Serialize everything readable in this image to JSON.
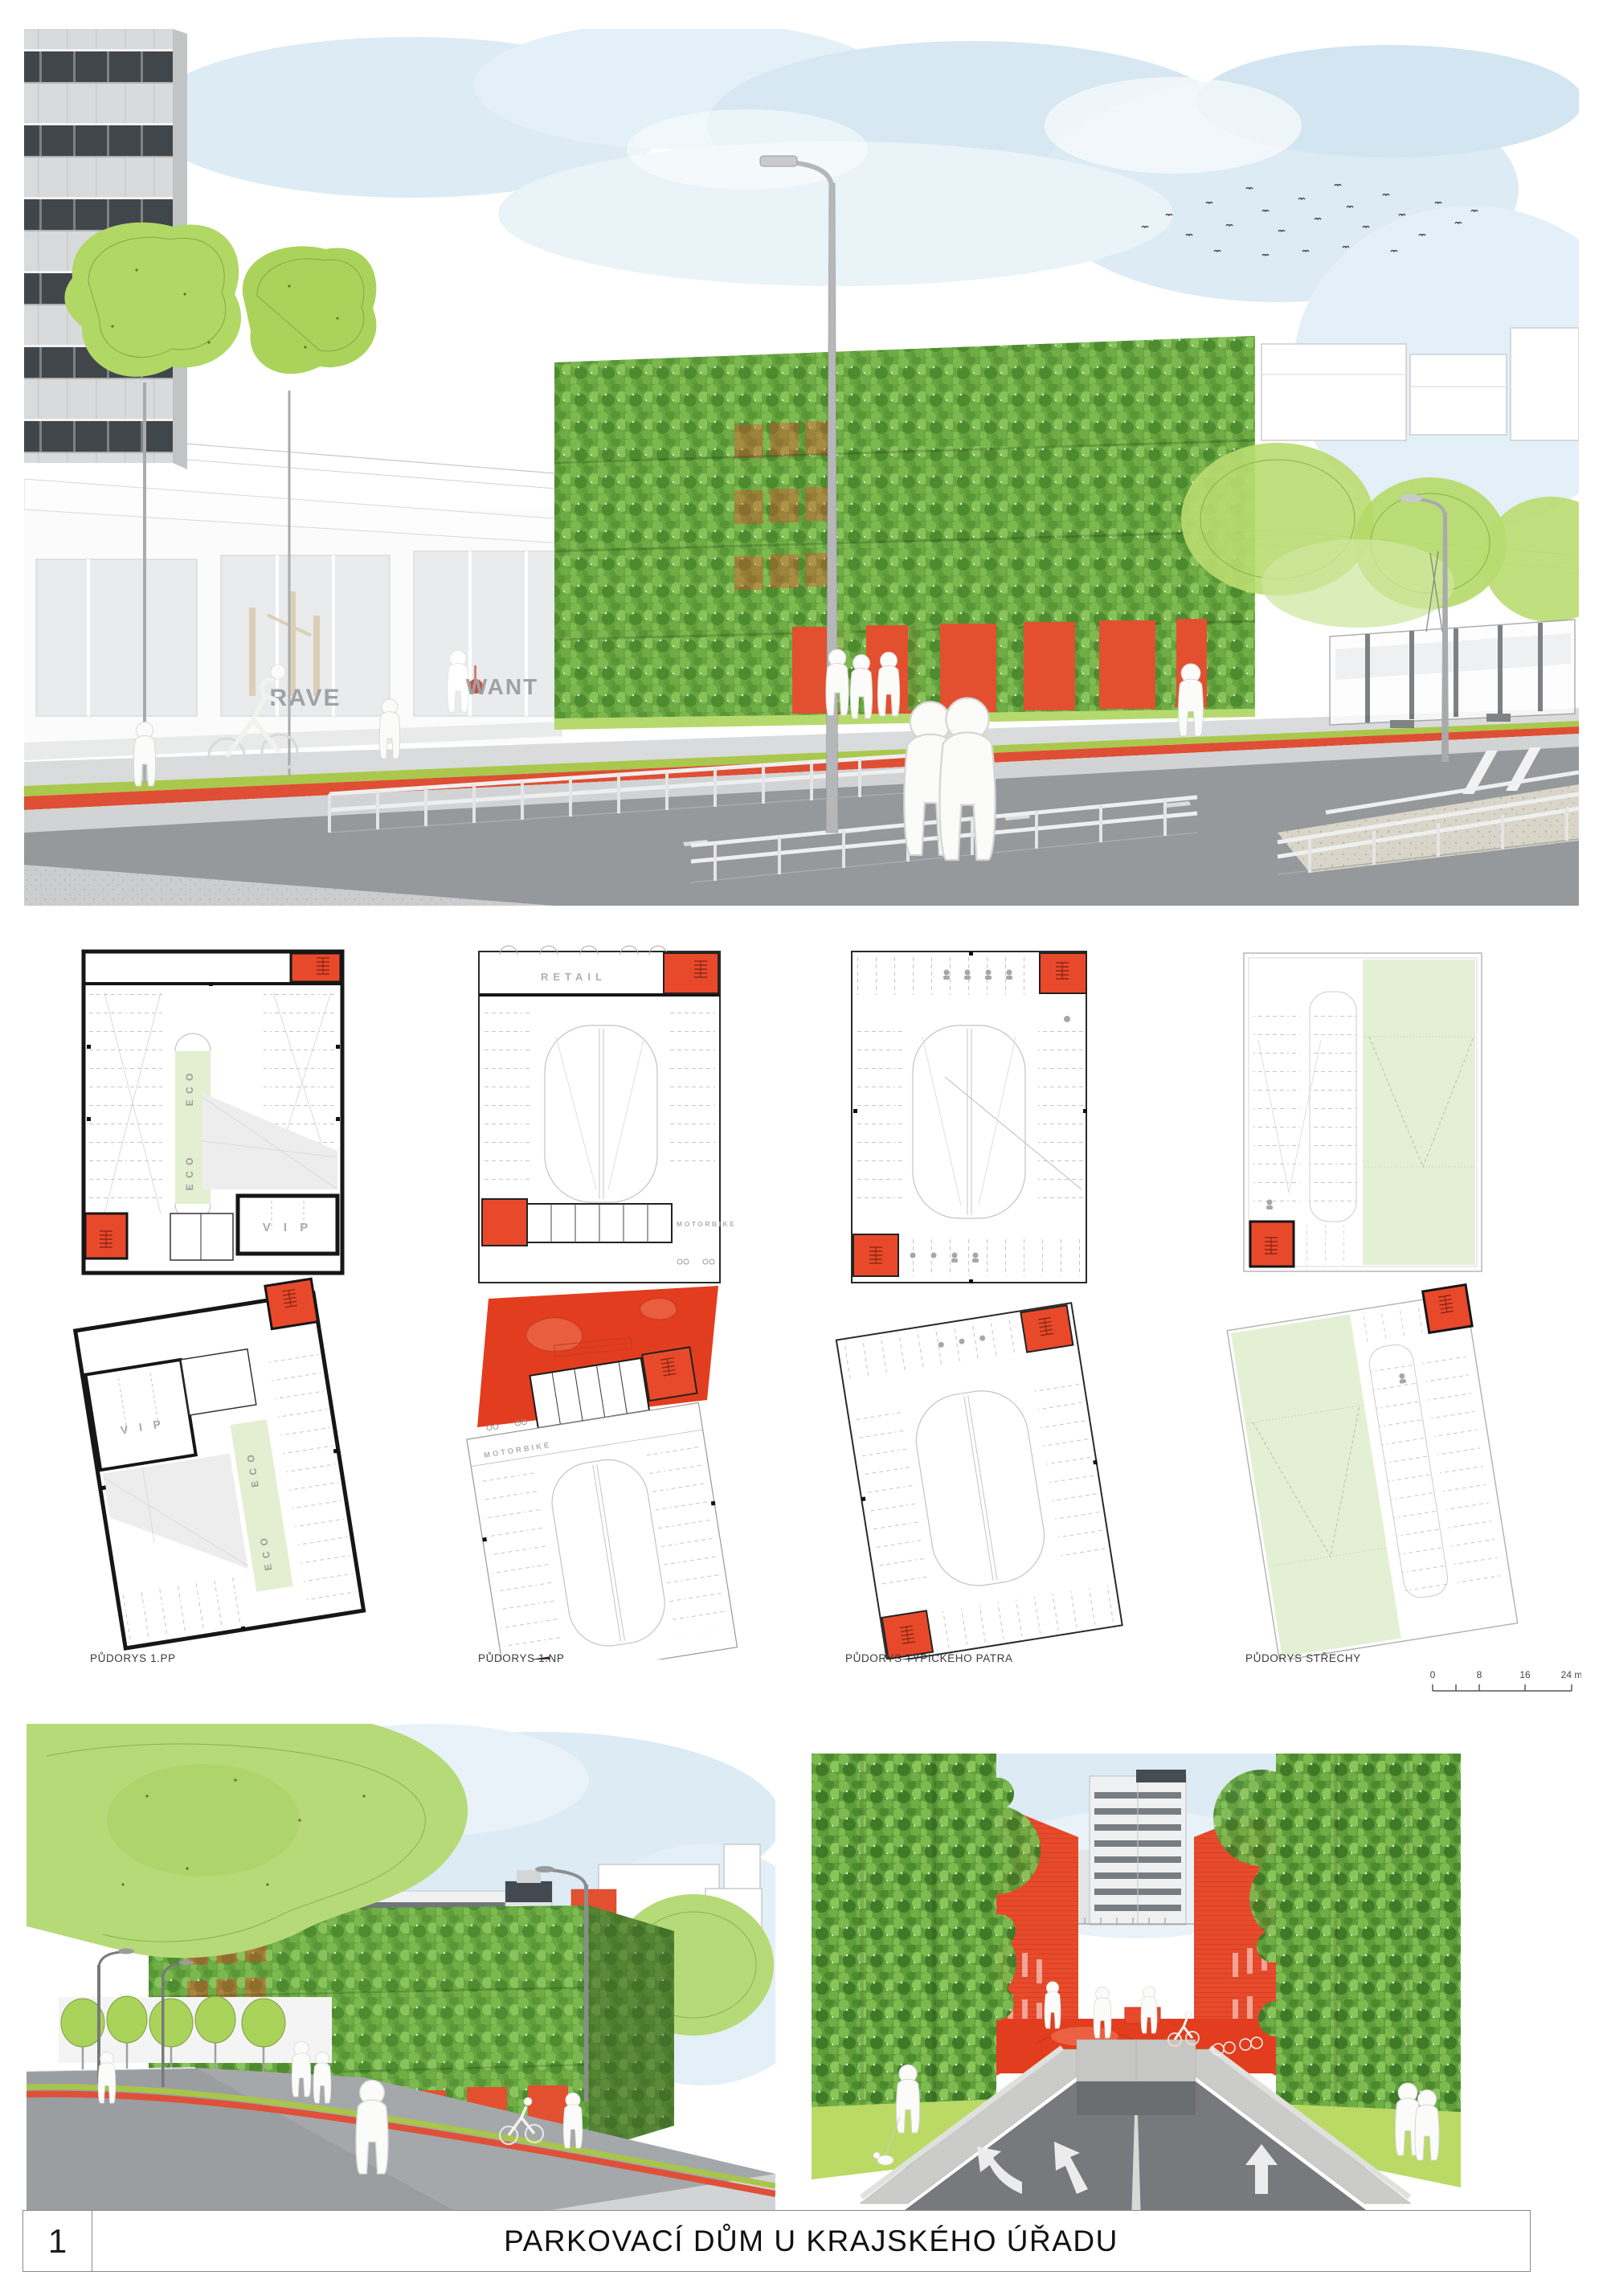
{
  "footer": {
    "sheet_number": "1",
    "title": "PARKOVACÍ DŮM U KRAJSKÉHO ÚŘADU"
  },
  "plans": {
    "labels": {
      "pp": "PŮDORYS 1.PP",
      "np": "PŮDORYS 1.NP",
      "typical": "PŮDORYS TYPICKÉHO PATRA",
      "roof": "PŮDORYS STŘECHY"
    },
    "annotations": {
      "retail": "RETAIL",
      "motorbike": "MOTORBIKE",
      "vip": "V I P",
      "eco": "E C O"
    }
  },
  "scale_bar": {
    "t0": "0",
    "t8": "8",
    "t16": "16",
    "t24": "24 m"
  },
  "top_rendering": {
    "shop_sign_left": "RAVE",
    "shop_sign_right": "WANT"
  },
  "colors": {
    "accent_red": "#e8492b",
    "plaza_red": "#e23d1f",
    "tree_green": "#aed45f",
    "eco_green": "#e4f0d3",
    "sky_blue": "#d9eaf3",
    "facade_green": "#68a441",
    "road_gray": "#96999b"
  }
}
